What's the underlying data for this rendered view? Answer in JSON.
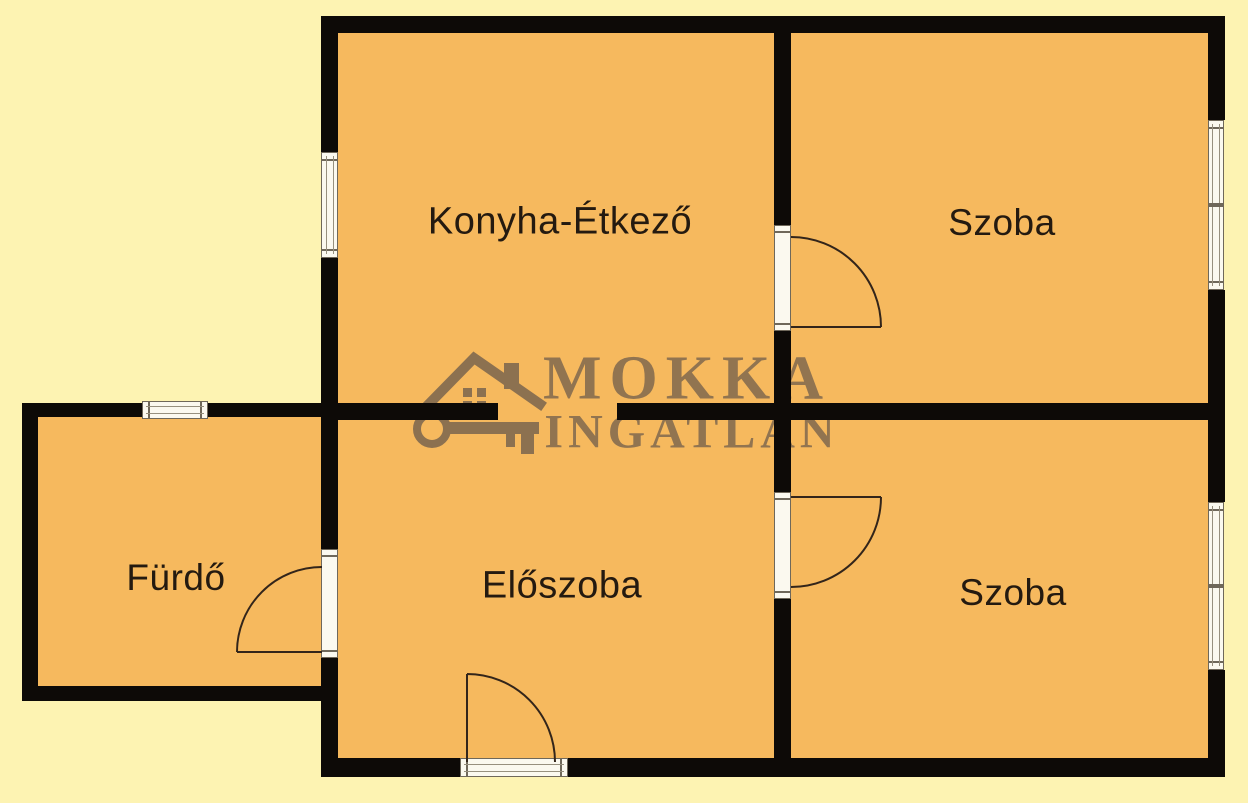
{
  "title": "Lakás alaprajz",
  "rooms": [
    {
      "id": "konyha-etkezo",
      "label": "Konyha-Étkező"
    },
    {
      "id": "szoba-felso",
      "label": "Szoba"
    },
    {
      "id": "furdo",
      "label": "Fürdő"
    },
    {
      "id": "eloszoba",
      "label": "Előszoba"
    },
    {
      "id": "szoba-also",
      "label": "Szoba"
    }
  ],
  "watermark": {
    "line1": "MOKKA",
    "line2": "INGATLAN",
    "icon": "house-key-icon"
  },
  "features": {
    "doors": 4,
    "windows": 4,
    "entrance_door_wall": "bottom"
  },
  "colors": {
    "floor": "#f6b95e",
    "background": "#fdf3b2",
    "wall": "#0d0a07",
    "watermark": "#8c7150",
    "door_arc": "#33251a",
    "label": "#241a10",
    "window_fill": "#fbf9ef"
  }
}
